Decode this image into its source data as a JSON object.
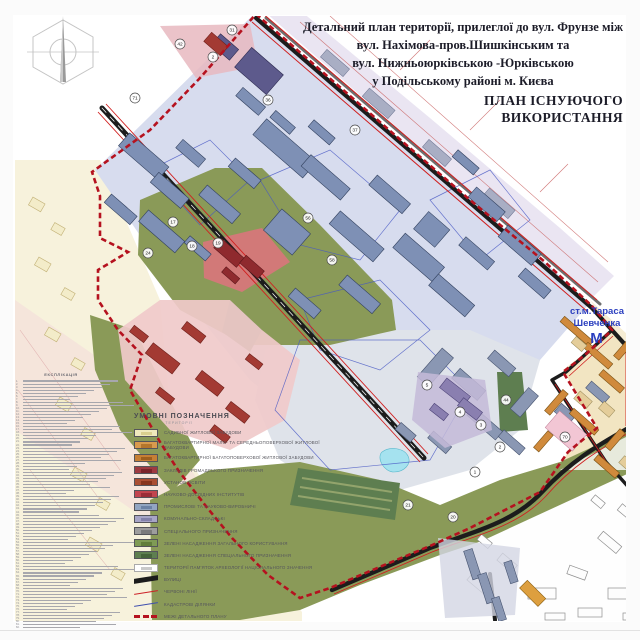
{
  "title_block": {
    "line1": "Детальний план території, прилеглої до вул. Фрунзе між",
    "line2": "вул. Нахімова-пров.Шишкінським та",
    "line3": "вул. Нижньоюрківською -Юрківською",
    "line4": "у Подільському районі м. Києва",
    "heading_line1": "ПЛАН ІСНУЮЧОГО",
    "heading_line2": "ВИКОРИСТАННЯ"
  },
  "metro": {
    "line1": "ст.м.Тараса",
    "line2": "Шевченка",
    "symbol": "М",
    "color": "#2b3fbf"
  },
  "legend": {
    "title": "УМОВНІ ПОЗНАЧЕННЯ",
    "subtitle": "ТЕРИТОРІЇ",
    "items": [
      {
        "type": "swatch",
        "color": "#efe9bc",
        "inner": "#d9cf8e",
        "label": "САДИБНОЇ ЖИТЛОВОЇ ЗАБУДОВИ"
      },
      {
        "type": "swatch",
        "color": "#d89a4e",
        "inner": "#b5762c",
        "label": "БАГАТОКВАРТИРНОЇ МАЛО- ТА СЕРЕДНЬОПОВЕРХОВОЇ ЖИТЛОВОЇ ЗАБУДОВИ"
      },
      {
        "type": "swatch",
        "color": "#c67f35",
        "inner": "#9e5e1e",
        "label": "БАГАТОКВАРТИРНОЇ БАГАТОПОВЕРХОВОЇ ЖИТЛОВОЇ ЗАБУДОВИ"
      },
      {
        "type": "swatch",
        "color": "#9e3a41",
        "inner": "#7a242b",
        "label": "ЗАКЛАДІВ ГРОМАДСЬКОГО ПРИЗНАЧЕННЯ"
      },
      {
        "type": "swatch",
        "color": "#aa4f33",
        "inner": "#86351d",
        "label": "УСТАНОВ ОСВІТИ"
      },
      {
        "type": "swatch",
        "color": "#c2454f",
        "inner": "#9b2e38",
        "label": "НАУКОВО-ДОСЛІДНИХ ІНСТИТУТІВ"
      },
      {
        "type": "swatch",
        "color": "#92a5c2",
        "inner": "#6c82a6",
        "label": "ПРОМИСЛОВІ ТА НАУКОВО-ВИРОБНИЧІ"
      },
      {
        "type": "swatch",
        "color": "#a7a5c6",
        "inner": "#8481ab",
        "label": "КОМУНАЛЬНО-СКЛАДСЬКІ"
      },
      {
        "type": "swatch",
        "color": "#9d9d9d",
        "inner": "#7b7b7b",
        "label": "СПЕЦІАЛЬНОГО ПРИЗНАЧЕННЯ"
      },
      {
        "type": "swatch",
        "color": "#7f9b55",
        "inner": "#627e3c",
        "label": "ЗЕЛЕНІ НАСАДЖЕННЯ ЗАГАЛЬНОГО КОРИСТУВАННЯ"
      },
      {
        "type": "swatch",
        "color": "#5e7f50",
        "inner": "#46643a",
        "label": "ЗЕЛЕНІ НАСАДЖЕННЯ СПЕЦІАЛЬНОГО ПРИЗНАЧЕННЯ"
      },
      {
        "type": "outline",
        "color": "#ffffff",
        "inner": "#c9c9c9",
        "label": "ТЕРИТОРІЇ ПАМ'ЯТОК АРХЕОЛОГІЇ НАЦІОНАЛЬНОГО ЗНАЧЕННЯ"
      },
      {
        "type": "wedge",
        "color": "#1c1c1c",
        "label": "ВУЛИЦІ"
      },
      {
        "type": "line",
        "color": "#cc2127",
        "thick": 1.6,
        "label": "ЧЕРВОНІ ЛІНІЇ"
      },
      {
        "type": "line",
        "color": "#3f4fae",
        "thick": 1.2,
        "label": "КАДАСТРОВІ ДІЛЯНКИ"
      },
      {
        "type": "dashes",
        "color": "#b5121f",
        "label": "МЕЖІ ДЕТАЛЬНОГО ПЛАНУ"
      }
    ]
  },
  "explication": {
    "title": "ЕКСПЛІКАЦІЯ",
    "line_count": 82
  },
  "map_labels": [
    {
      "n": "71",
      "x": 135,
      "y": 98
    },
    {
      "n": "31",
      "x": 232,
      "y": 30
    },
    {
      "n": "42",
      "x": 180,
      "y": 44
    },
    {
      "n": "2",
      "x": 213,
      "y": 57
    },
    {
      "n": "36",
      "x": 268,
      "y": 100
    },
    {
      "n": "37",
      "x": 355,
      "y": 130
    },
    {
      "n": "56",
      "x": 308,
      "y": 218
    },
    {
      "n": "17",
      "x": 173,
      "y": 222
    },
    {
      "n": "19",
      "x": 218,
      "y": 243
    },
    {
      "n": "24",
      "x": 148,
      "y": 253
    },
    {
      "n": "18",
      "x": 192,
      "y": 246
    },
    {
      "n": "58",
      "x": 332,
      "y": 260
    },
    {
      "n": "5",
      "x": 427,
      "y": 385
    },
    {
      "n": "44",
      "x": 506,
      "y": 400
    },
    {
      "n": "4",
      "x": 460,
      "y": 412
    },
    {
      "n": "3",
      "x": 481,
      "y": 425
    },
    {
      "n": "2",
      "x": 500,
      "y": 447
    },
    {
      "n": "1",
      "x": 475,
      "y": 472
    },
    {
      "n": "21",
      "x": 408,
      "y": 505
    },
    {
      "n": "20",
      "x": 453,
      "y": 517
    },
    {
      "n": "70",
      "x": 565,
      "y": 437
    }
  ],
  "colors": {
    "boundary": "#b5121f",
    "red_line": "#d01f1f",
    "road": "#1c1c1c",
    "industrial_field": "#d7dcee",
    "industrial_building": "#7e90b5",
    "green": "#8a9a58",
    "green_dark": "#5e7e50",
    "research_pink": "#f0caca",
    "residential_tan": "#f2e5c2",
    "lake": "#a5e2ef",
    "cadastre": "#4758c4"
  }
}
